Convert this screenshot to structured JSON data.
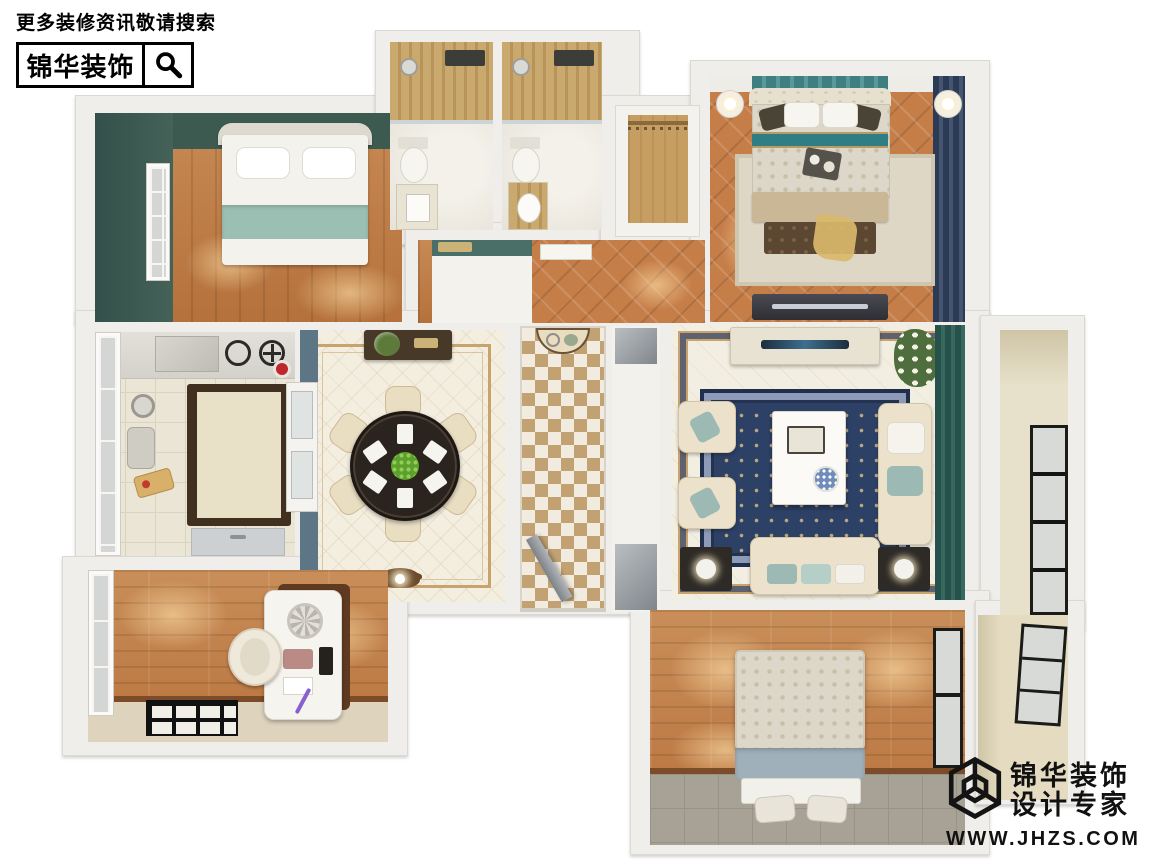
{
  "watermark_top": {
    "search_hint": "更多装修资讯敬请搜索",
    "brand_name": "锦华装饰",
    "icon": "magnifier-icon"
  },
  "watermark_bottom": {
    "brand_name": "锦华装饰",
    "tagline": "设计专家",
    "website": "WWW.JHZS.COM",
    "icon": "cube-logo-icon"
  },
  "colors": {
    "background": "#ffffff",
    "wall": "#efeeea",
    "wood_floor": "#c07c46",
    "green_accent_wall": "#3c5a50",
    "teal_textile": "#9cbfb3",
    "gold_shower_tile": "#c9ab72",
    "navy_curtain": "#2b3a55",
    "teal_curtain": "#2f5d58",
    "navy_rug": "#2d4166",
    "cream_furniture": "#ece2cb",
    "dining_border_gold": "#c8a36c",
    "watermark_text": "#111111"
  },
  "floorplan": {
    "rooms": [
      {
        "id": "bedroom-top-left",
        "floor": "wood"
      },
      {
        "id": "bathroom-left",
        "floor": "marble"
      },
      {
        "id": "bathroom-right",
        "floor": "marble"
      },
      {
        "id": "wardrobe-closet",
        "floor": "white"
      },
      {
        "id": "master-bedroom",
        "floor": "parquet"
      },
      {
        "id": "kitchen",
        "floor": "tile"
      },
      {
        "id": "dining-room",
        "floor": "marble-mosaic"
      },
      {
        "id": "entry-hallway",
        "floor": "pinwheel-mosaic"
      },
      {
        "id": "inner-corridor",
        "floor": "tile"
      },
      {
        "id": "living-room",
        "floor": "tile"
      },
      {
        "id": "balcony-right",
        "floor": "tile"
      },
      {
        "id": "study",
        "floor": "wood"
      },
      {
        "id": "bedroom-bottom-right",
        "floor": "wood-tile"
      },
      {
        "id": "balcony-bottom-right",
        "floor": "tile"
      }
    ]
  }
}
